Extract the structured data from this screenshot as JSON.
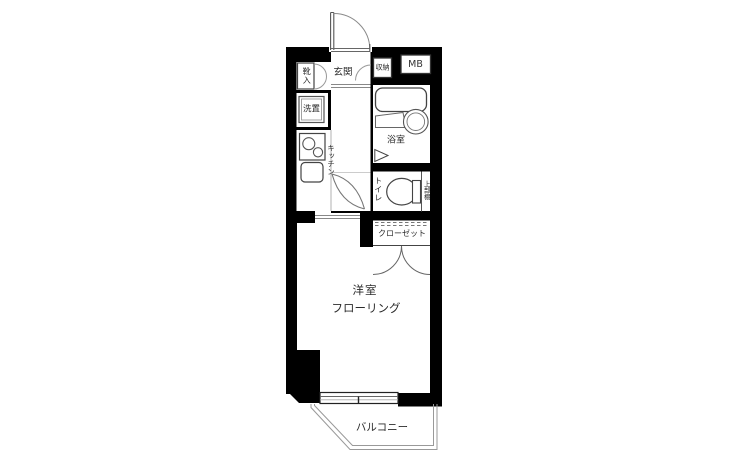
{
  "labels": {
    "genkan": "玄関",
    "shoe_cabinet": "靴入",
    "storage": "収納",
    "meter_box": "MB",
    "laundry": "洗置",
    "kitchen": "キッチン",
    "bathroom": "浴室",
    "toilet": "トイレ",
    "upper_shelf": "上部棚",
    "closet": "クローゼット",
    "room": "洋室",
    "flooring": "フローリング",
    "balcony": "バルコニー"
  },
  "colors": {
    "wall": "#000000",
    "fixture_line": "#555555",
    "thin_line": "#999999",
    "text": "#2b2b2b",
    "background": "#ffffff"
  }
}
